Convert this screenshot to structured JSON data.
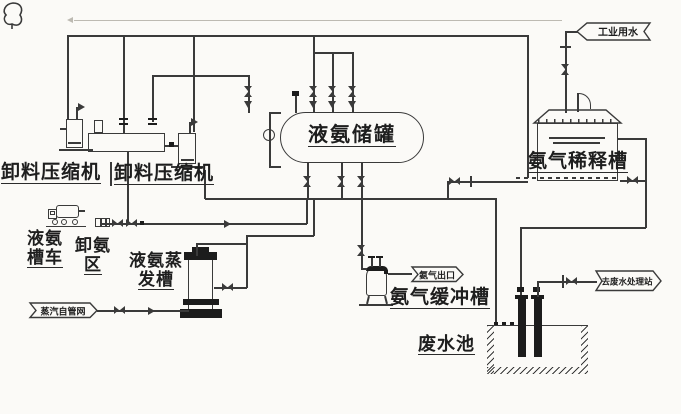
{
  "colors": {
    "ink": "#3a3a3a",
    "paper": "#fbfaf7"
  },
  "equipment": {
    "compressor_left": {
      "label": "卸料压缩机"
    },
    "compressor_right": {
      "label": "卸料压缩机"
    },
    "tanker": {
      "line1": "液氨",
      "line2": "槽车"
    },
    "unloading_area": {
      "line1": "卸氨",
      "line2": "区"
    },
    "evaporator": {
      "line1": "液氨蒸",
      "line2": "发槽"
    },
    "storage_tank": {
      "label": "液氨储罐"
    },
    "dilution_tank": {
      "label": "氨气稀释槽"
    },
    "buffer_tank": {
      "label": "氨气缓冲槽"
    },
    "waste_pool": {
      "label": "废水池"
    }
  },
  "flags": {
    "industrial_water": {
      "label": "工业用水"
    },
    "steam_network": {
      "label": "蒸汽自管网"
    },
    "ammonia_outlet": {
      "label": "氨气出口"
    },
    "to_wastewater_station": {
      "label": "去废水处理站"
    }
  }
}
